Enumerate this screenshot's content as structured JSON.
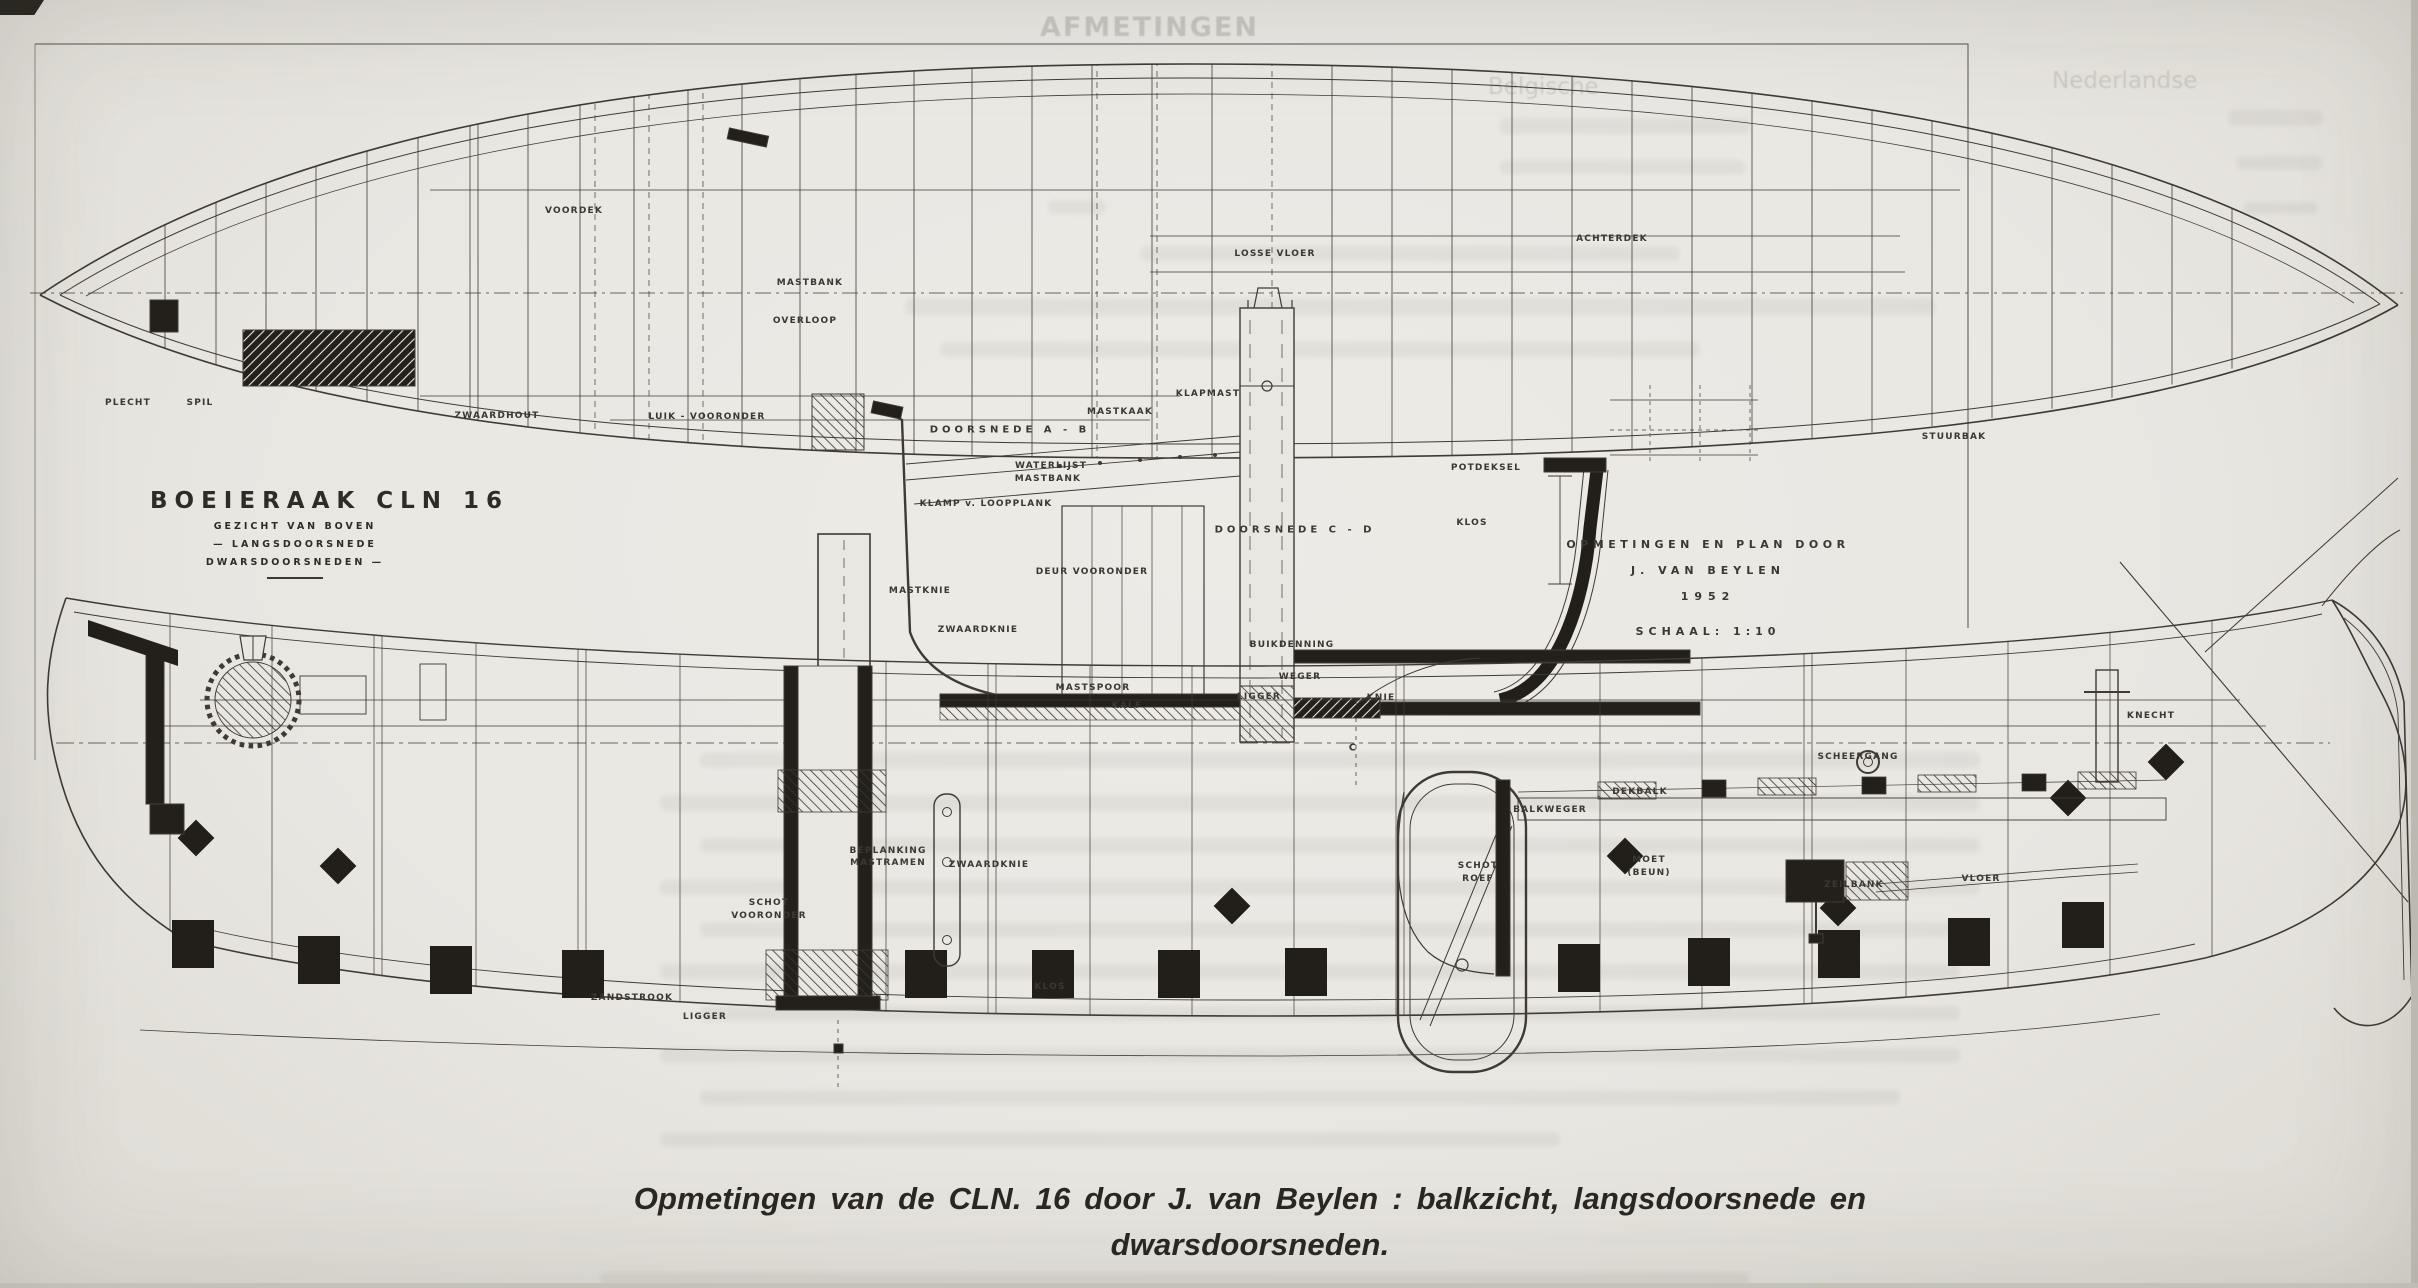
{
  "title_block": {
    "title": "BOEIERAAK  CLN 16",
    "line1": "GEZICHT VAN BOVEN",
    "line2": "— LANGSDOORSNEDE",
    "line3": "DWARSDOORSNEDEN —"
  },
  "credit_block": {
    "line1": "OPMETINGEN EN PLAN DOOR",
    "line2": "J. VAN BEYLEN",
    "line3": "1952",
    "line4": "SCHAAL: 1:10"
  },
  "caption": {
    "line1": "Opmetingen van de CLN. 16 door J. van Beylen : balkzicht, langsdoorsnede en",
    "line2": "dwarsdoorsneden."
  },
  "ghost": {
    "heading": "AFMETINGEN",
    "col1": "Belgische",
    "col2": "Nederlandse",
    "smudges": [
      [
        1500,
        118,
        250,
        16
      ],
      [
        2228,
        110,
        95,
        16
      ],
      [
        1500,
        160,
        245,
        14
      ],
      [
        2236,
        156,
        86,
        14
      ],
      [
        1048,
        200,
        58,
        14
      ],
      [
        2244,
        202,
        74,
        12
      ],
      [
        1140,
        246,
        540,
        15
      ],
      [
        905,
        298,
        1030,
        17
      ],
      [
        940,
        342,
        760,
        15
      ],
      [
        700,
        752,
        1280,
        16
      ],
      [
        660,
        795,
        1320,
        16
      ],
      [
        700,
        838,
        1280,
        15
      ],
      [
        660,
        880,
        1320,
        15
      ],
      [
        700,
        922,
        1280,
        15
      ],
      [
        660,
        964,
        1300,
        15
      ],
      [
        700,
        1006,
        1260,
        15
      ],
      [
        660,
        1048,
        1300,
        15
      ],
      [
        700,
        1090,
        1200,
        15
      ],
      [
        660,
        1132,
        900,
        15
      ],
      [
        600,
        1272,
        1150,
        14
      ]
    ]
  },
  "plan_labels": [
    {
      "t": "PLECHT",
      "x": 128,
      "y": 403
    },
    {
      "t": "SPIL",
      "x": 200,
      "y": 403
    },
    {
      "t": "VOORDEK",
      "x": 574,
      "y": 211
    },
    {
      "t": "MASTBANK",
      "x": 810,
      "y": 283
    },
    {
      "t": "OVERLOOP",
      "x": 805,
      "y": 321
    },
    {
      "t": "ZWAARDHOUT",
      "x": 497,
      "y": 416
    },
    {
      "t": "LUIK - VOORONDER",
      "x": 707,
      "y": 417
    },
    {
      "t": "LOSSE VLOER",
      "x": 1275,
      "y": 254
    },
    {
      "t": "ACHTERDEK",
      "x": 1612,
      "y": 239
    },
    {
      "t": "STUURBAK",
      "x": 1954,
      "y": 437
    }
  ],
  "section_labels": [
    {
      "t": "DOORSNEDE  A - B",
      "x": 1010,
      "y": 430,
      "s": 10,
      "w": 4
    },
    {
      "t": "KLAPMAST",
      "x": 1208,
      "y": 394
    },
    {
      "t": "MASTKAAK",
      "x": 1120,
      "y": 412
    },
    {
      "t": "WATERLIJST",
      "x": 1051,
      "y": 466
    },
    {
      "t": "MASTBANK",
      "x": 1048,
      "y": 479
    },
    {
      "t": "KLAMP v. LOOPPLANK",
      "x": 986,
      "y": 504
    },
    {
      "t": "DOORSNEDE  C - D",
      "x": 1295,
      "y": 530,
      "s": 10,
      "w": 4
    },
    {
      "t": "DEUR  VOORONDER",
      "x": 1092,
      "y": 572
    },
    {
      "t": "MASTKNIE",
      "x": 920,
      "y": 591
    },
    {
      "t": "ZWAARDKNIE",
      "x": 978,
      "y": 630
    },
    {
      "t": "BUIKDENNING",
      "x": 1292,
      "y": 645
    },
    {
      "t": "WEGER",
      "x": 1300,
      "y": 677
    },
    {
      "t": "MASTSPOOR",
      "x": 1093,
      "y": 688
    },
    {
      "t": "KALF",
      "x": 1127,
      "y": 706
    },
    {
      "t": "LIGGER",
      "x": 1259,
      "y": 697
    },
    {
      "t": "KNIE",
      "x": 1381,
      "y": 698
    },
    {
      "t": "POTDEKSEL",
      "x": 1486,
      "y": 468
    },
    {
      "t": "KLOS",
      "x": 1472,
      "y": 523
    },
    {
      "t": "C",
      "x": 1353,
      "y": 748,
      "s": 10
    }
  ],
  "profile_labels": [
    {
      "t": "KNECHT",
      "x": 2151,
      "y": 716
    },
    {
      "t": "SCHEERGANG",
      "x": 1858,
      "y": 757
    },
    {
      "t": "DEKBALK",
      "x": 1640,
      "y": 792
    },
    {
      "t": "BALKWEGER",
      "x": 1550,
      "y": 810
    },
    {
      "t": "SCHOT",
      "x": 1478,
      "y": 866
    },
    {
      "t": "ROEF",
      "x": 1478,
      "y": 879
    },
    {
      "t": "MOET",
      "x": 1649,
      "y": 860
    },
    {
      "t": "(BEUN)",
      "x": 1649,
      "y": 873
    },
    {
      "t": "ZEILBANK",
      "x": 1854,
      "y": 885
    },
    {
      "t": "VLOER",
      "x": 1981,
      "y": 879
    },
    {
      "t": "BEPLANKING",
      "x": 888,
      "y": 851
    },
    {
      "t": "MASTRAMEN",
      "x": 888,
      "y": 863
    },
    {
      "t": "ZWAARDKNIE",
      "x": 989,
      "y": 865
    },
    {
      "t": "SCHOT",
      "x": 769,
      "y": 903
    },
    {
      "t": "VOORONDER",
      "x": 769,
      "y": 916
    },
    {
      "t": "ZANDSTROOK",
      "x": 632,
      "y": 998
    },
    {
      "t": "LIGGER",
      "x": 705,
      "y": 1017
    },
    {
      "t": "KLOS",
      "x": 1050,
      "y": 987
    }
  ]
}
